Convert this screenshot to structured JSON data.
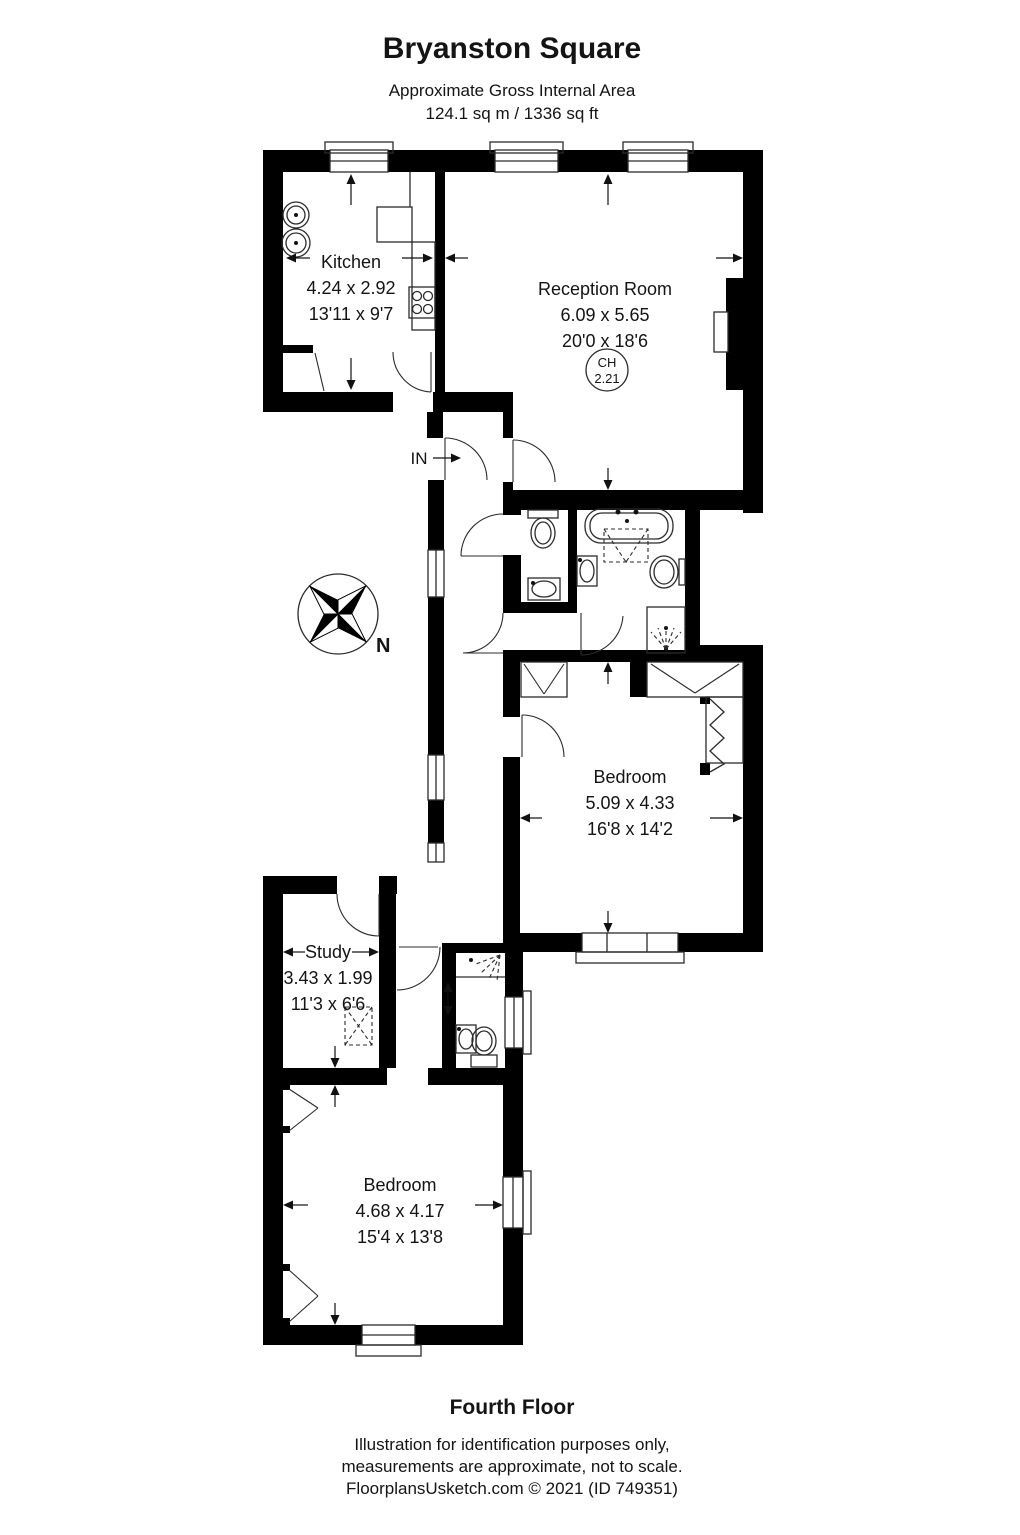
{
  "header": {
    "title": "Bryanston Square",
    "subtitle": "Approximate Gross Internal Area",
    "area": "124.1 sq m / 1336 sq ft"
  },
  "plan": {
    "entry_label": "IN",
    "compass_label": "N",
    "ceiling": {
      "label": "CH",
      "value": "2.21"
    },
    "rooms": [
      {
        "id": "kitchen",
        "name": "Kitchen",
        "metric": "4.24 x 2.92",
        "imperial": "13'11 x 9'7"
      },
      {
        "id": "reception",
        "name": "Reception Room",
        "metric": "6.09 x 5.65",
        "imperial": "20'0 x 18'6"
      },
      {
        "id": "bedroom-1",
        "name": "Bedroom",
        "metric": "5.09 x 4.33",
        "imperial": "16'8 x 14'2"
      },
      {
        "id": "study",
        "name": "Study",
        "metric": "3.43 x 1.99",
        "imperial": "11'3 x 6'6"
      },
      {
        "id": "bedroom-2",
        "name": "Bedroom",
        "metric": "4.68 x 4.17",
        "imperial": "15'4 x 13'8"
      }
    ]
  },
  "footer": {
    "floor_label": "Fourth Floor",
    "disclaimer": [
      "Illustration for identification purposes only,",
      "measurements are approximate, not to scale.",
      "FloorplansUsketch.com © 2021 (ID 749351)"
    ]
  }
}
